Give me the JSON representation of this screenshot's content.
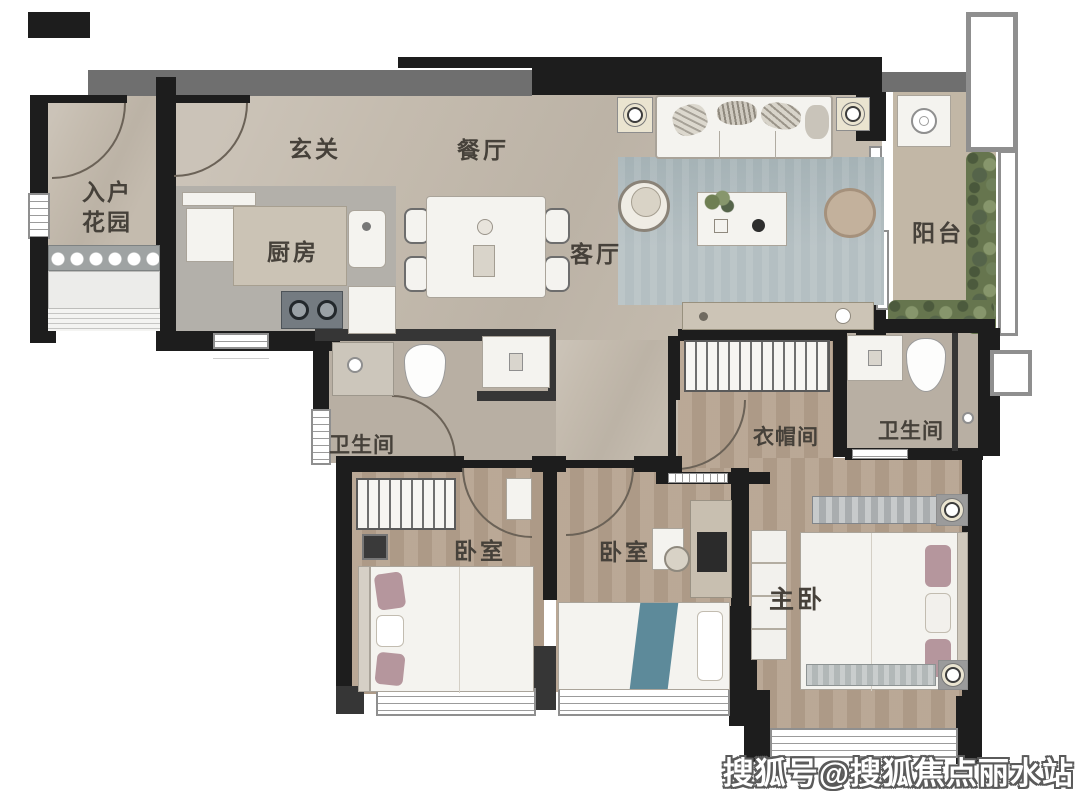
{
  "palette": {
    "wall": "#1d1d1d",
    "wall_gray": "#6f6f6f",
    "floor_main": "#c4bbae",
    "floor_wood": "#b5a28e",
    "floor_bath": "#b8afa3",
    "floor_balcony": "#c2b7a6",
    "rug": "#b4bfc2",
    "furniture_white": "#f4f3ef",
    "counter_gray": "#b3b0aa",
    "island_beige": "#cbc3b5",
    "plant_green": "#66754e",
    "accent_pink": "#b5969d",
    "accent_blue": "#5d8a9a",
    "label_text": "#46413a",
    "watermark_fill": "#ffffff",
    "watermark_outline": "#505050"
  },
  "rooms": {
    "entry_garden_line1": "入户",
    "entry_garden_line2": "花园",
    "foyer": "玄关",
    "dining": "餐厅",
    "kitchen": "厨房",
    "living": "客厅",
    "balcony": "阳台",
    "bath1": "卫生间",
    "closet": "衣帽间",
    "bath2": "卫生间",
    "bedroom1": "卧室",
    "bedroom2": "卧室",
    "master": "主卧"
  },
  "watermark": "搜狐号@搜狐焦点丽水站"
}
